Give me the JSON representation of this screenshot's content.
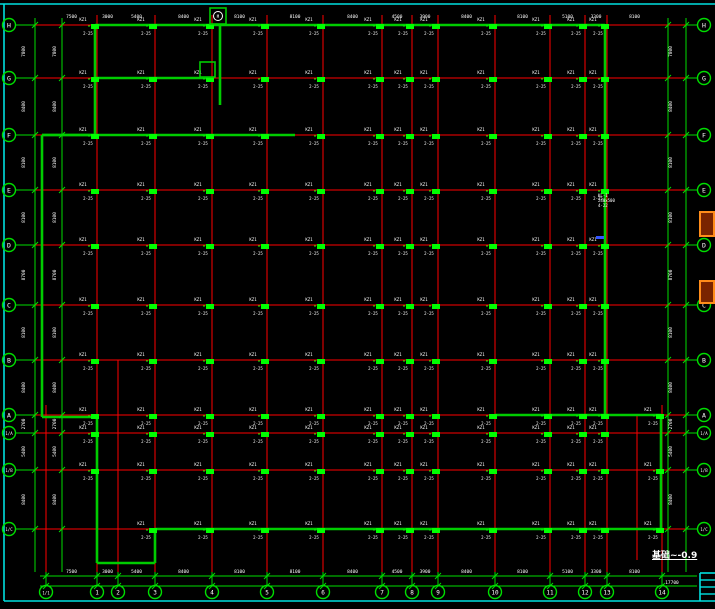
{
  "drawing": {
    "note": "基础~-0.9",
    "colors": {
      "bg": "#000000",
      "grid_red": "#ff0000",
      "green": "#00dd00",
      "wall_green": "#00cc00",
      "column_green": "#00ff00",
      "text_white": "#ffffff",
      "border_cyan": "#00e0e0",
      "orange": "#ff8c1a",
      "orange_fill": "#7a2400",
      "blue": "#3355ff"
    },
    "rows": [
      {
        "label": "H",
        "y": 25
      },
      {
        "label": "G",
        "y": 78
      },
      {
        "label": "F",
        "y": 135
      },
      {
        "label": "E",
        "y": 190
      },
      {
        "label": "D",
        "y": 245
      },
      {
        "label": "C",
        "y": 305
      },
      {
        "label": "B",
        "y": 360
      },
      {
        "label": "A",
        "y": 415
      },
      {
        "label": "1/A",
        "y": 433
      },
      {
        "label": "1/B",
        "y": 470
      },
      {
        "label": "1/C",
        "y": 529
      }
    ],
    "cols": [
      {
        "label": "1/1",
        "x": 46,
        "y1": 405
      },
      {
        "label": "1",
        "x": 97
      },
      {
        "label": "2",
        "x": 118,
        "y1": 360
      },
      {
        "label": "3",
        "x": 155
      },
      {
        "label": "4",
        "x": 212
      },
      {
        "label": "5",
        "x": 267
      },
      {
        "label": "6",
        "x": 323
      },
      {
        "label": "7",
        "x": 382
      },
      {
        "label": "8",
        "x": 412
      },
      {
        "label": "9",
        "x": 438
      },
      {
        "label": "10",
        "x": 495
      },
      {
        "label": "11",
        "x": 550
      },
      {
        "label": "12",
        "x": 585
      },
      {
        "label": "13",
        "x": 607
      },
      {
        "label": "14",
        "x": 662,
        "y1": 405
      }
    ],
    "row_dims": [
      "7800",
      "8400",
      "8100",
      "8100",
      "8700",
      "8100",
      "8400",
      "2700",
      "5400",
      "8400"
    ],
    "col_dims": [
      "7500",
      "3000",
      "5400",
      "8400",
      "8100",
      "8100",
      "8400",
      "4500",
      "3900",
      "8400",
      "8100",
      "5100",
      "3300",
      "8100"
    ],
    "bottom_total": "17700",
    "column_tag": {
      "t1": "KZ1",
      "t2": "2-25"
    },
    "note_block": [
      "KL-1",
      "240x500",
      "4-22"
    ],
    "detail_mark": "M",
    "outline": [
      [
        95,
        25,
        605,
        25
      ],
      [
        95,
        25,
        95,
        135
      ],
      [
        95,
        135,
        42,
        135
      ],
      [
        42,
        135,
        42,
        417
      ],
      [
        42,
        417,
        97,
        417
      ],
      [
        97,
        417,
        97,
        563
      ],
      [
        97,
        563,
        155,
        563
      ],
      [
        155,
        563,
        155,
        529
      ],
      [
        155,
        529,
        661,
        529
      ],
      [
        661,
        529,
        661,
        415
      ],
      [
        661,
        415,
        605,
        415
      ],
      [
        605,
        415,
        605,
        25
      ]
    ],
    "beams": [
      [
        95,
        78,
        210,
        78
      ],
      [
        42,
        135,
        295,
        135
      ],
      [
        220,
        25,
        220,
        105
      ],
      [
        495,
        415,
        605,
        415
      ]
    ],
    "orange_boxes": [
      {
        "x": 700,
        "y": 212,
        "w": 14,
        "h": 24
      },
      {
        "x": 700,
        "y": 281,
        "w": 14,
        "h": 22
      }
    ],
    "detail_box": {
      "x": 210,
      "y": 8,
      "size": 16
    },
    "small_box": {
      "x": 200,
      "y": 62,
      "size": 15
    },
    "blue_tick": {
      "x": 596,
      "y": 236,
      "w": 8,
      "h": 3
    },
    "title_block": {
      "x": 700,
      "y": 573,
      "y2": 601,
      "row_ys": [
        580,
        587,
        594
      ]
    }
  }
}
